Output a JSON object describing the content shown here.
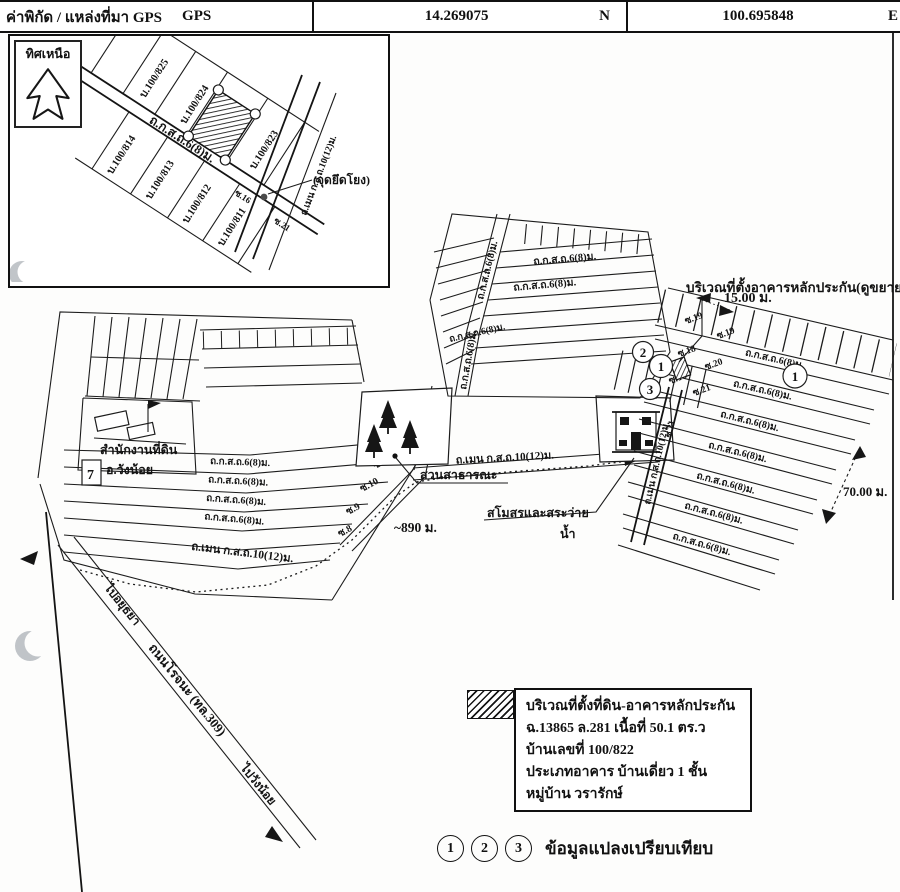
{
  "header": {
    "title": "ค่าพิกัด / แหล่งที่มา GPS",
    "source": "GPS",
    "lat": "14.269075",
    "lat_dir": "N",
    "lon": "100.695848",
    "lon_dir": "E"
  },
  "inset": {
    "north_label": "ทิศเหนือ",
    "road_label": "ถ.ก.ส.ถ.6(8)ม.",
    "cross_road_label": "ถ.เมน ก.ส.ถ.10(12)ม.",
    "anchor_label": "(จุดยึดโยง)",
    "soi16": "ซ.16",
    "soi21": "ซ.21",
    "houses": {
      "h825": "บ.100/825",
      "h824": "บ.100/824",
      "h823": "บ.100/823",
      "h814": "บ.100/814",
      "h813": "บ.100/813",
      "h812": "บ.100/812",
      "h811": "บ.100/811"
    }
  },
  "map": {
    "expand_label": "บริเวณที่ตั้งอาคารหลักประกัน(ดูขยาย)",
    "width_dim": "15.00 ม.",
    "depth_dim": "70.00 ม.",
    "route_distance": "~890 ม.",
    "road_68": "ถ.ก.ส.ถ.6(8)ม.",
    "road_main": "ถ.เมน ก.ส.ถ.10(12)ม.",
    "rojana_road": "ถนนโรจนะ (ทล.309)",
    "to_ayutthaya": "ไปอยุธยา",
    "to_wangnoi": "ไปวังน้อย",
    "park_label": "สวนสาธารณะ",
    "club_label": "สโมสรและสระว่าย",
    "club_label2": "น้ำ",
    "land_office_label": "สำนักงานที่ดิน",
    "land_office_label2": "อ.วังน้อย",
    "seven_label": "7",
    "markers": {
      "m1": "1",
      "m2": "2",
      "m3": "3"
    },
    "soi": {
      "s8": "ซ.8",
      "s9": "ซ.9",
      "s10": "ซ.10",
      "s11": "ซ.11",
      "s12": "ซ.12",
      "s16": "ซ.16",
      "s18": "ซ.18",
      "s19": "ซ.19",
      "s20": "ซ.20",
      "s21": "ซ.21"
    }
  },
  "legend": {
    "line1": "บริเวณที่ตั้งที่ดิน-อาคารหลักประกัน",
    "line2": "ฉ.13865 ล.281 เนื้อที่ 50.1 ตร.ว",
    "line3": "บ้านเลขที่  100/822",
    "line4": "ประเภทอาคาร บ้านเดี่ยว 1 ชั้น",
    "line5": "หมู่บ้าน วรารักษ์"
  },
  "footer": {
    "m1": "1",
    "m2": "2",
    "m3": "3",
    "label": "ข้อมูลแปลงเปรียบเทียบ"
  }
}
